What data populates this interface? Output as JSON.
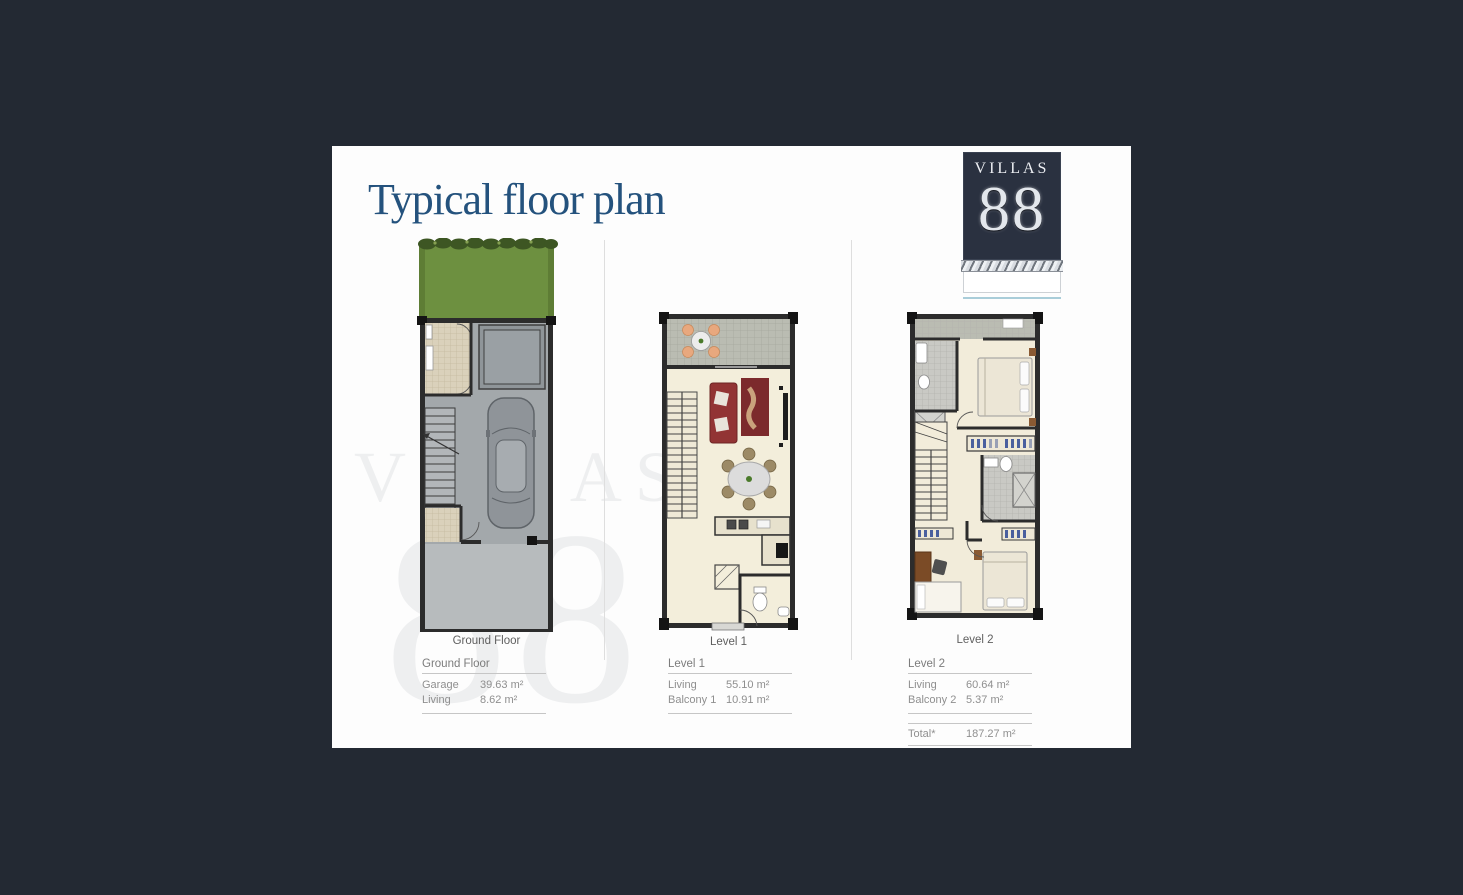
{
  "title": "Typical floor plan",
  "logo": {
    "name": "VILLAS",
    "number": "88"
  },
  "watermark": {
    "line1": "VILLAS",
    "line2": "88"
  },
  "plans": [
    {
      "caption": "Ground Floor",
      "table": {
        "header": "Ground Floor",
        "rows": [
          {
            "label": "Garage",
            "value": "39.63 m²"
          },
          {
            "label": "Living",
            "value": "8.62 m²"
          }
        ]
      }
    },
    {
      "caption": "Level 1",
      "table": {
        "header": "Level 1",
        "rows": [
          {
            "label": "Living",
            "value": "55.10 m²"
          },
          {
            "label": "Balcony 1",
            "value": "10.91 m²"
          }
        ]
      }
    },
    {
      "caption": "Level 2",
      "table": {
        "header": "Level 2",
        "rows": [
          {
            "label": "Living",
            "value": "60.64 m²"
          },
          {
            "label": "Balcony 2",
            "value": "5.37 m²"
          }
        ],
        "total": {
          "label": "Total*",
          "value": "187.27 m²"
        }
      }
    }
  ],
  "colors": {
    "background": "#232933",
    "sheet": "#fdfdfd",
    "title_blue": "#24527d",
    "logo_navy": "#2a3140",
    "logo_underline": "#a9cdd9",
    "grass": "#6d9040",
    "wall": "#2c2c2c",
    "cream_floor": "#f3eedb",
    "sofa_red": "#923434"
  }
}
